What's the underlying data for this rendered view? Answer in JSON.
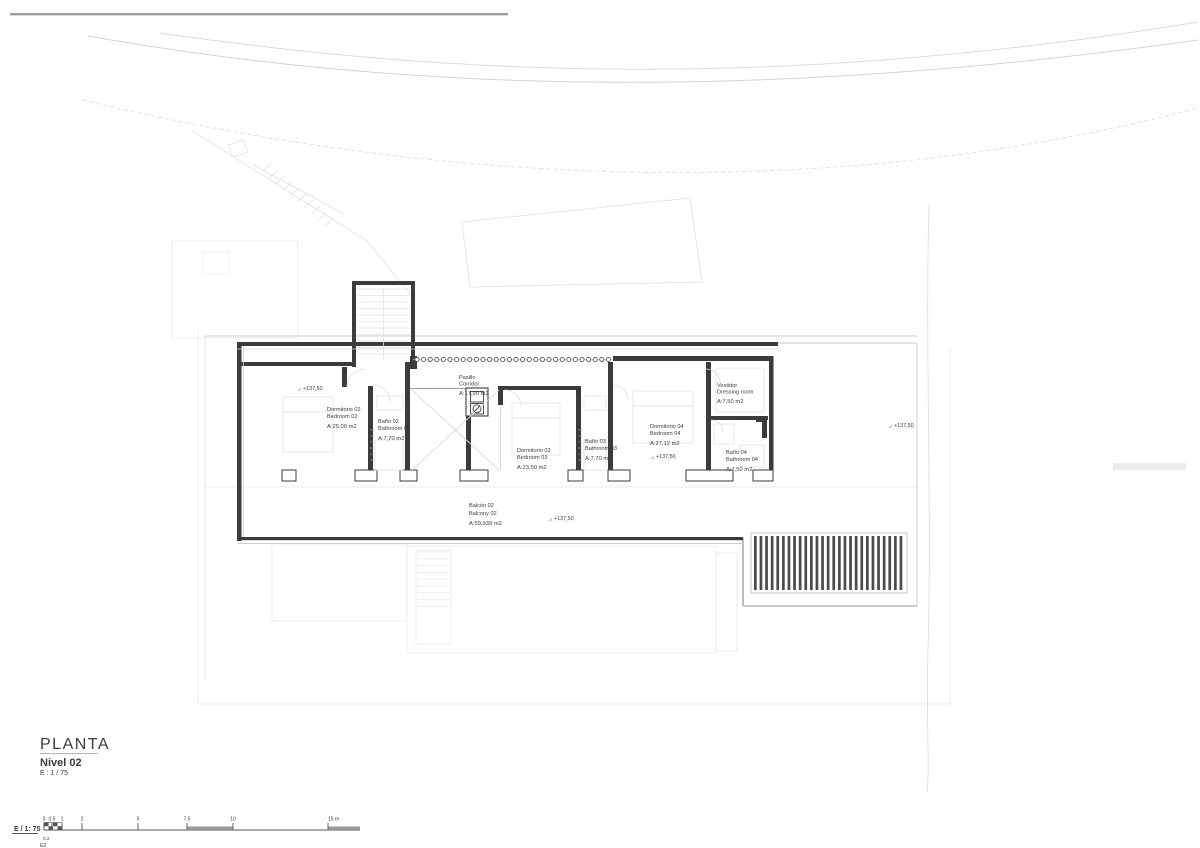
{
  "sheet": {
    "title": "PLANTA",
    "level": "Nivel 02",
    "scale_note": "E : 1 / 75"
  },
  "scale_bar": {
    "label": "E / 1: 75",
    "ticks": [
      "0",
      "0.5",
      "1",
      "2",
      "5",
      "7.5",
      "10",
      "15 m"
    ],
    "minor_tick": "0.2",
    "sheet_code": "E2"
  },
  "level_mark": "+137,50",
  "rooms": [
    {
      "id": "bedroom-02",
      "name_es": "Dormitorio 02",
      "name_en": "Bedroom 02",
      "area": "A:25,00 m2"
    },
    {
      "id": "bathroom-02",
      "name_es": "Baño 02",
      "name_en": "Bathroom 02",
      "area": "A:7,70 m2"
    },
    {
      "id": "corridor",
      "name_es": "Pasillo",
      "name_en": "Corridor",
      "area": "A:17,90 m2"
    },
    {
      "id": "bedroom-03",
      "name_es": "Dormitorio 03",
      "name_en": "Bedroom 03",
      "area": "A:23,50 m2"
    },
    {
      "id": "bathroom-03",
      "name_es": "Baño 03",
      "name_en": "Bathroom 03",
      "area": "A:7,70 m2"
    },
    {
      "id": "bedroom-04",
      "name_es": "Dormitorio 04",
      "name_en": "Bedroom 04",
      "area": "A:27,12 m2"
    },
    {
      "id": "dressing-room",
      "name_es": "Vestidor",
      "name_en": "Dressing room",
      "area": "A:7,50 m2"
    },
    {
      "id": "bathroom-04",
      "name_es": "Baño 04",
      "name_en": "Bathroom 04",
      "area": "A:7,50 m2"
    },
    {
      "id": "balcony-02",
      "name_es": "Balcón 02",
      "name_en": "Balcony 02",
      "area": "A:59,939 m2"
    }
  ],
  "colors": {
    "wall": "#3b3b3b",
    "medium_line": "#9aa1ab",
    "light_line": "#c7ccd6",
    "faint_line": "#e3e6ee",
    "site_line": "#d9d9d9",
    "gray_bar": "#ededed",
    "text": "#3c3c3c",
    "muted_text": "#8f8f8f"
  }
}
